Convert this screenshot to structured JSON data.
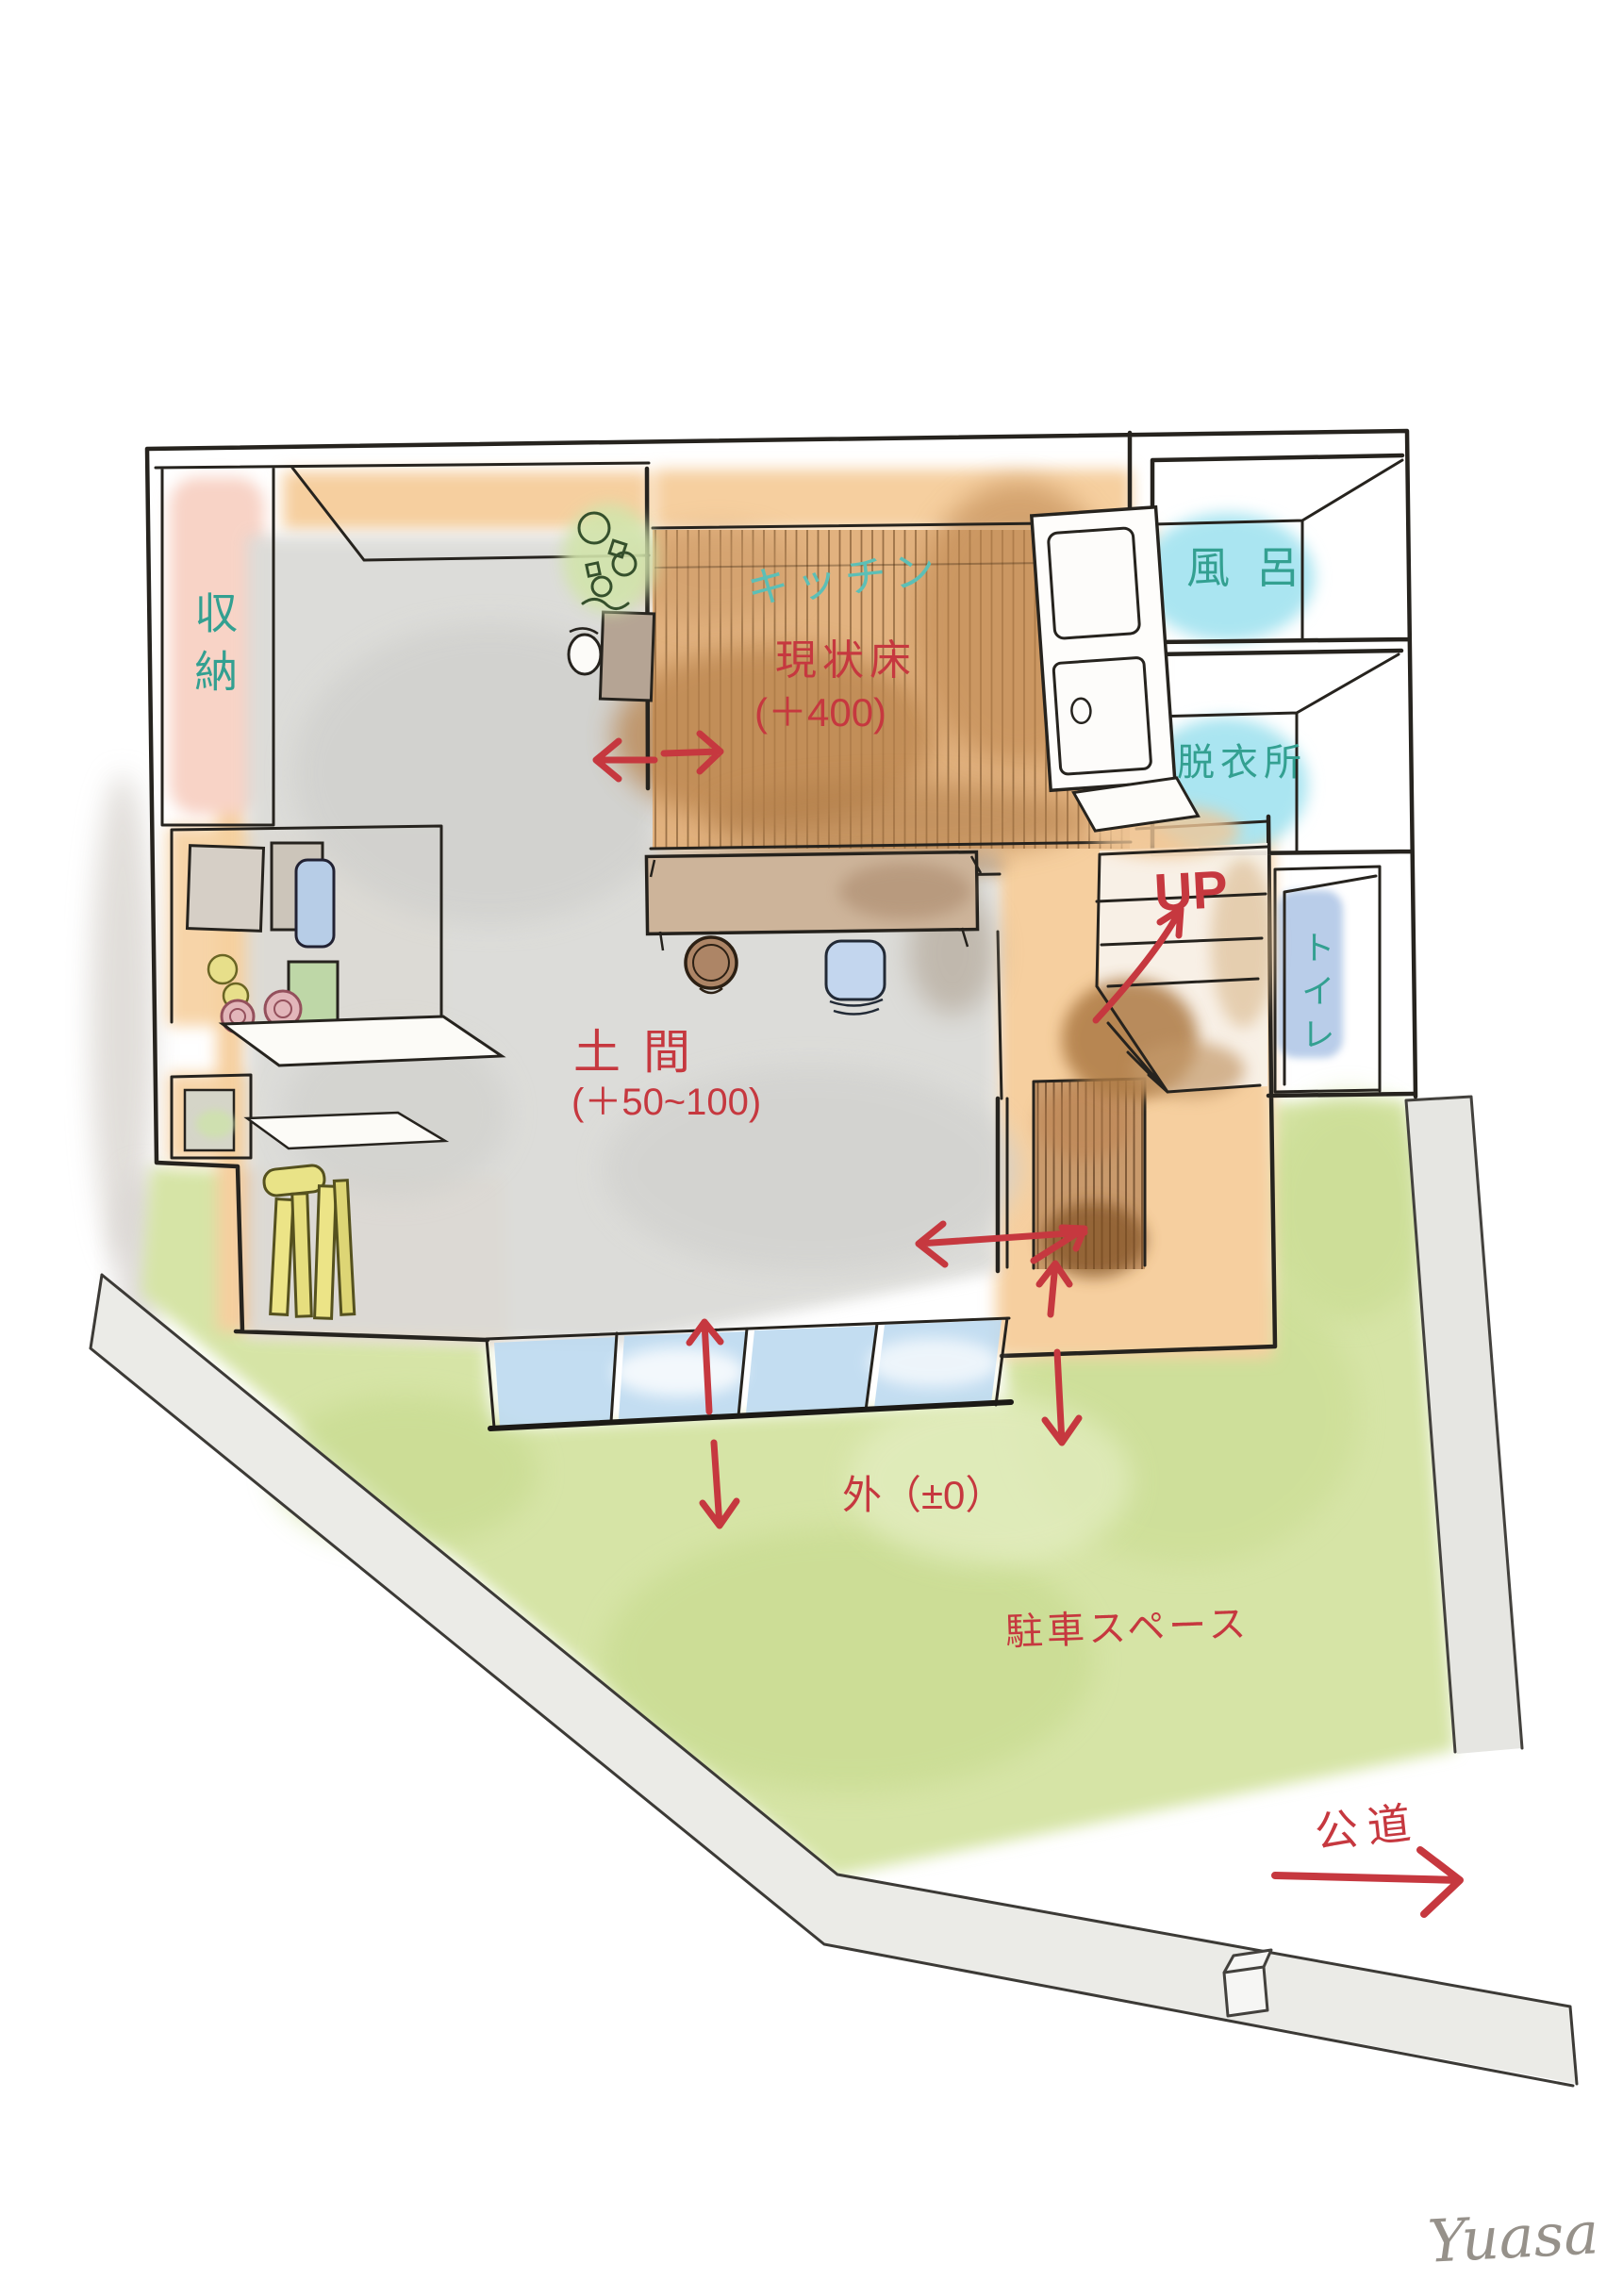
{
  "title": "hand-drawn renovation floor plan sketch",
  "labels": {
    "storage": "収納",
    "kitchen": "キッチン",
    "current_floor_line1": "現状床",
    "current_floor_line2": "(＋400)",
    "bath": "風呂",
    "dressing_room": "脱衣所",
    "toilet": "トイレ",
    "stairs_up": "UP",
    "doma_line1": "土間",
    "doma_line2": "(＋50~100)",
    "outside": "外（±0）",
    "parking": "駐車スペース",
    "public_road": "公道",
    "signature": "Yuasa"
  },
  "colors": {
    "annotation_red": "#c6383f",
    "room_label_teal": "#33a091",
    "kitchen_label_teal": "#5cbfb6",
    "signature_gray": "#96918a",
    "grass_green": "#d6e4a6",
    "wood_floor_brown": "#e2b27f",
    "doma_gray": "#dbdbd8",
    "storage_pink": "#f8d3c6",
    "wall_face_orange": "#f6cf9f",
    "wet_room_blue": "#aae5f1",
    "glass_blue": "#bdd9ef",
    "road_gray": "#ebebe7"
  }
}
